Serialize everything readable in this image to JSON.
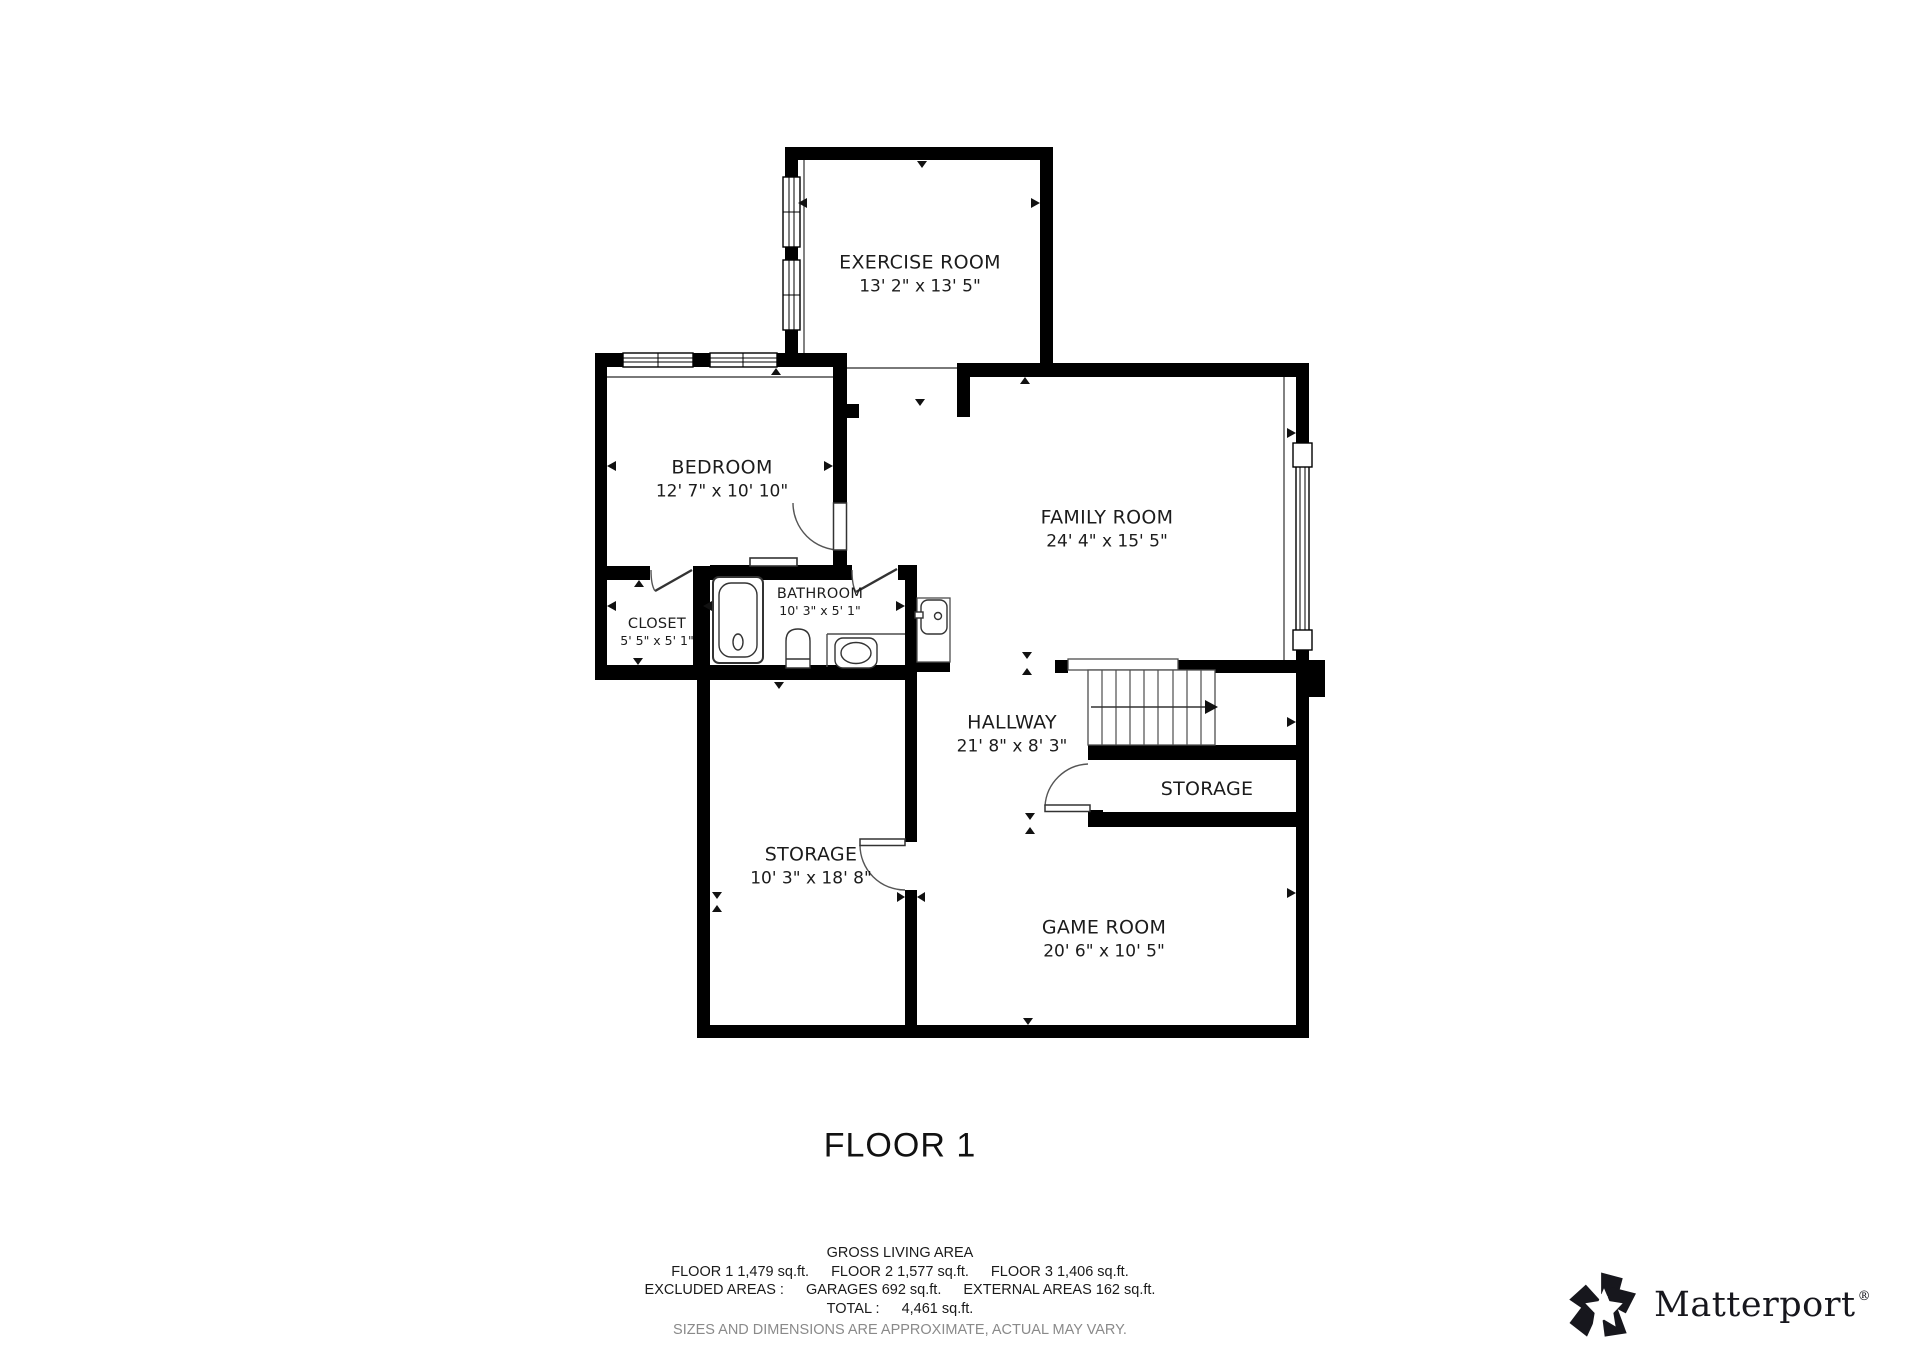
{
  "floor_title": "FLOOR 1",
  "rooms": [
    {
      "name": "EXERCISE ROOM",
      "dims": "13' 2\" x 13' 5\""
    },
    {
      "name": "BEDROOM",
      "dims": "12' 7\" x 10' 10\""
    },
    {
      "name": "FAMILY ROOM",
      "dims": "24' 4\" x 15' 5\""
    },
    {
      "name": "CLOSET",
      "dims": "5' 5\" x 5' 1\""
    },
    {
      "name": "BATHROOM",
      "dims": "10' 3\" x 5' 1\""
    },
    {
      "name": "HALLWAY",
      "dims": "21' 8\" x 8' 3\""
    },
    {
      "name": "STORAGE",
      "dims": ""
    },
    {
      "name": "STORAGE",
      "dims": "10' 3\" x 18' 8\""
    },
    {
      "name": "GAME ROOM",
      "dims": "20' 6\" x 10' 5\""
    }
  ],
  "summary": {
    "title": "GROSS LIVING AREA",
    "floors": [
      "FLOOR 1 1,479 sq.ft.",
      "FLOOR 2 1,577 sq.ft.",
      "FLOOR 3 1,406 sq.ft."
    ],
    "excluded": [
      "EXCLUDED AREAS :",
      "GARAGES 692 sq.ft.",
      "EXTERNAL AREAS 162 sq.ft."
    ],
    "total": [
      "TOTAL :",
      "4,461 sq.ft."
    ],
    "disclaimer": "SIZES AND DIMENSIONS ARE APPROXIMATE, ACTUAL MAY VARY."
  },
  "brand": {
    "name": "Matterport",
    "registered": "®",
    "logo_icon": "matterport-pinwheel-icon"
  },
  "colors": {
    "wall": "#000000",
    "thin_line": "#4d4d4d",
    "text": "#1c1c1c",
    "muted_text": "#8a8a8a"
  }
}
